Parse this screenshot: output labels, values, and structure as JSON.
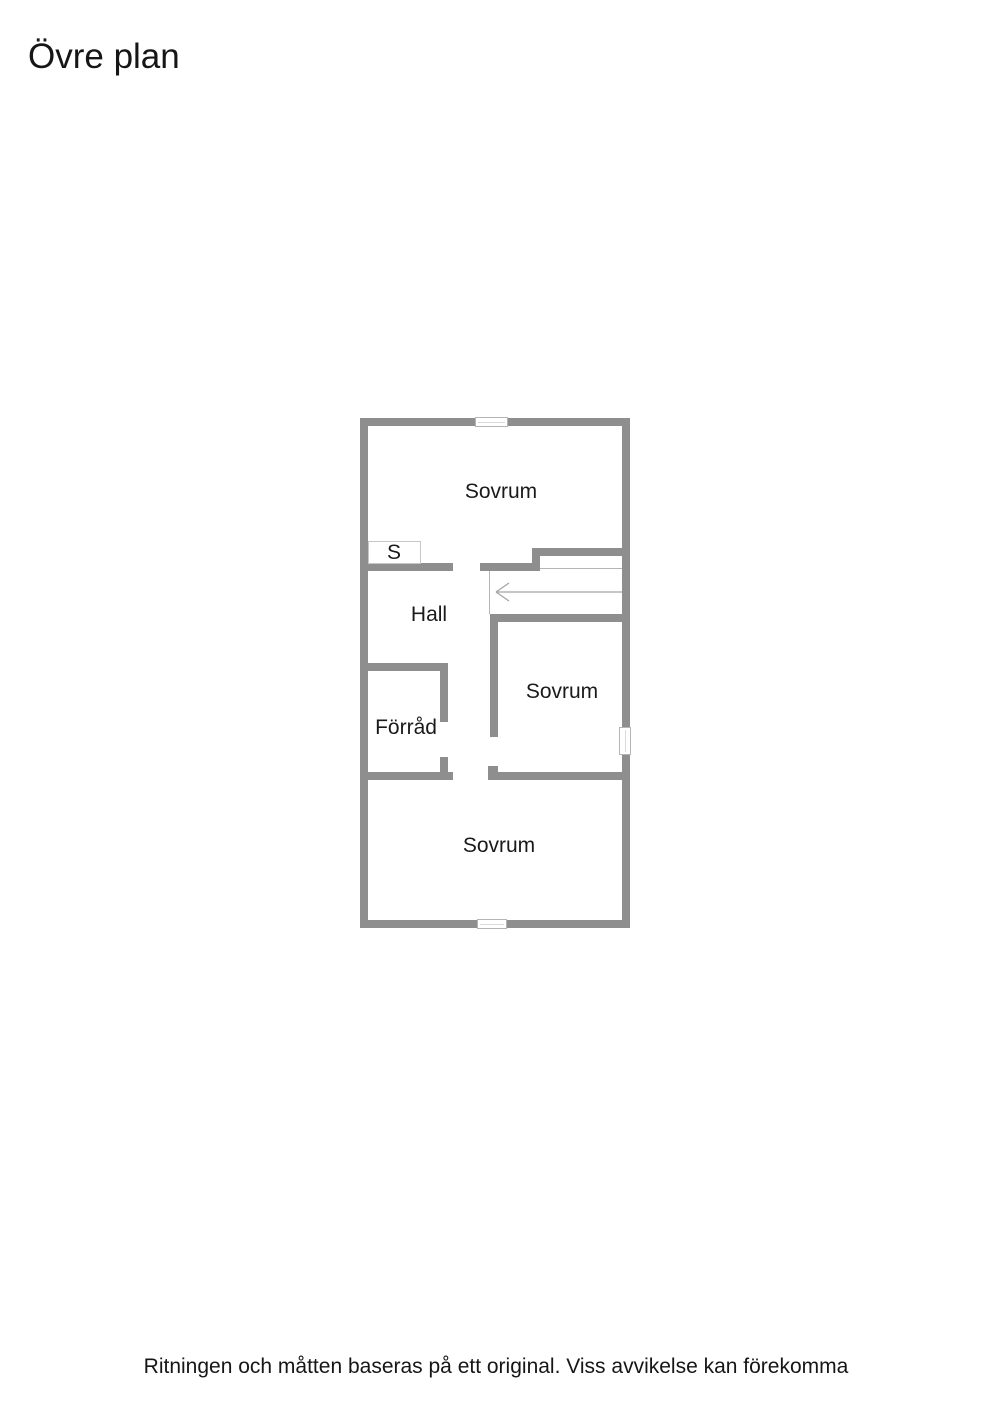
{
  "page": {
    "title": "Övre plan",
    "disclaimer": "Ritningen och måtten baseras på ett original. Viss avvikelse kan förekomma"
  },
  "floorplan": {
    "floor_name": "Övre plan",
    "wall_color": "#8e8e8e",
    "stair_line_color": "#b5b5b5",
    "arrow_color": "#a3a3a3",
    "label_color": "#1a1a1a",
    "rooms": [
      {
        "id": "sovrum-top",
        "label": "Sovrum"
      },
      {
        "id": "closet",
        "label": "S"
      },
      {
        "id": "hall",
        "label": "Hall"
      },
      {
        "id": "forrad",
        "label": "Förråd"
      },
      {
        "id": "sovrum-mid",
        "label": "Sovrum"
      },
      {
        "id": "sovrum-bottom",
        "label": "Sovrum"
      }
    ],
    "windows": [
      "top",
      "bottom",
      "right"
    ],
    "stairs": {
      "arrow_direction": "left"
    }
  }
}
